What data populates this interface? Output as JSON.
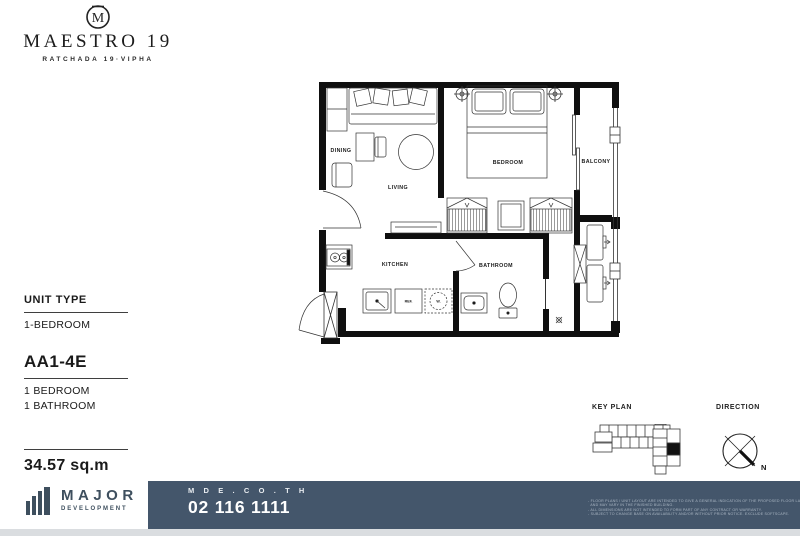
{
  "brand": {
    "crest_letter": "M",
    "name": "MAESTRO 19",
    "subtitle": "RATCHADA 19·VIPHA"
  },
  "unit_info": {
    "unit_type_label": "UNIT TYPE",
    "unit_type_value": "1-BEDROOM",
    "unit_code": "AA1-4E",
    "bedroom": "1 BEDROOM",
    "bathroom": "1 BATHROOM",
    "area": "34.57 sq.m"
  },
  "floor_plan": {
    "rooms": {
      "dining": "DINING",
      "living": "LIVING",
      "bedroom": "BEDROOM",
      "balcony": "BALCONY",
      "kitchen": "KITCHEN",
      "bathroom": "BATHROOM"
    },
    "appliances": {
      "refrigerator": "REF.",
      "washer": "W."
    }
  },
  "key_plan": {
    "label": "KEY PLAN",
    "highlight_color": "#111111"
  },
  "direction": {
    "label": "DIRECTION",
    "north": "N"
  },
  "footer": {
    "developer_name": "MAJOR",
    "developer_sub": "DEVELOPMENT",
    "website": "M D E . C O . T H",
    "phone": "02 116 1111",
    "bar_color": "#44566b",
    "disclaimer": [
      "- FLOOR PLANS / UNIT LAYOUT ARE INTENDED TO GIVE A GENERAL INDICATION OF THE PROPOSED FLOOR LAYOUT ONLY",
      "  AND MAY VARY IN THE FINISHED BUILDING.",
      "- ALL DIMENSIONS ARE NOT INTENDED TO FORM PART OF ANY CONTRACT OR WARRANTY.",
      "- SUBJECT TO CHANGE BASE ON AVAILABILITY AND/OR WITHOUT PRIOR NOTICE. EXCLUDE SOFTSCAPE."
    ]
  }
}
